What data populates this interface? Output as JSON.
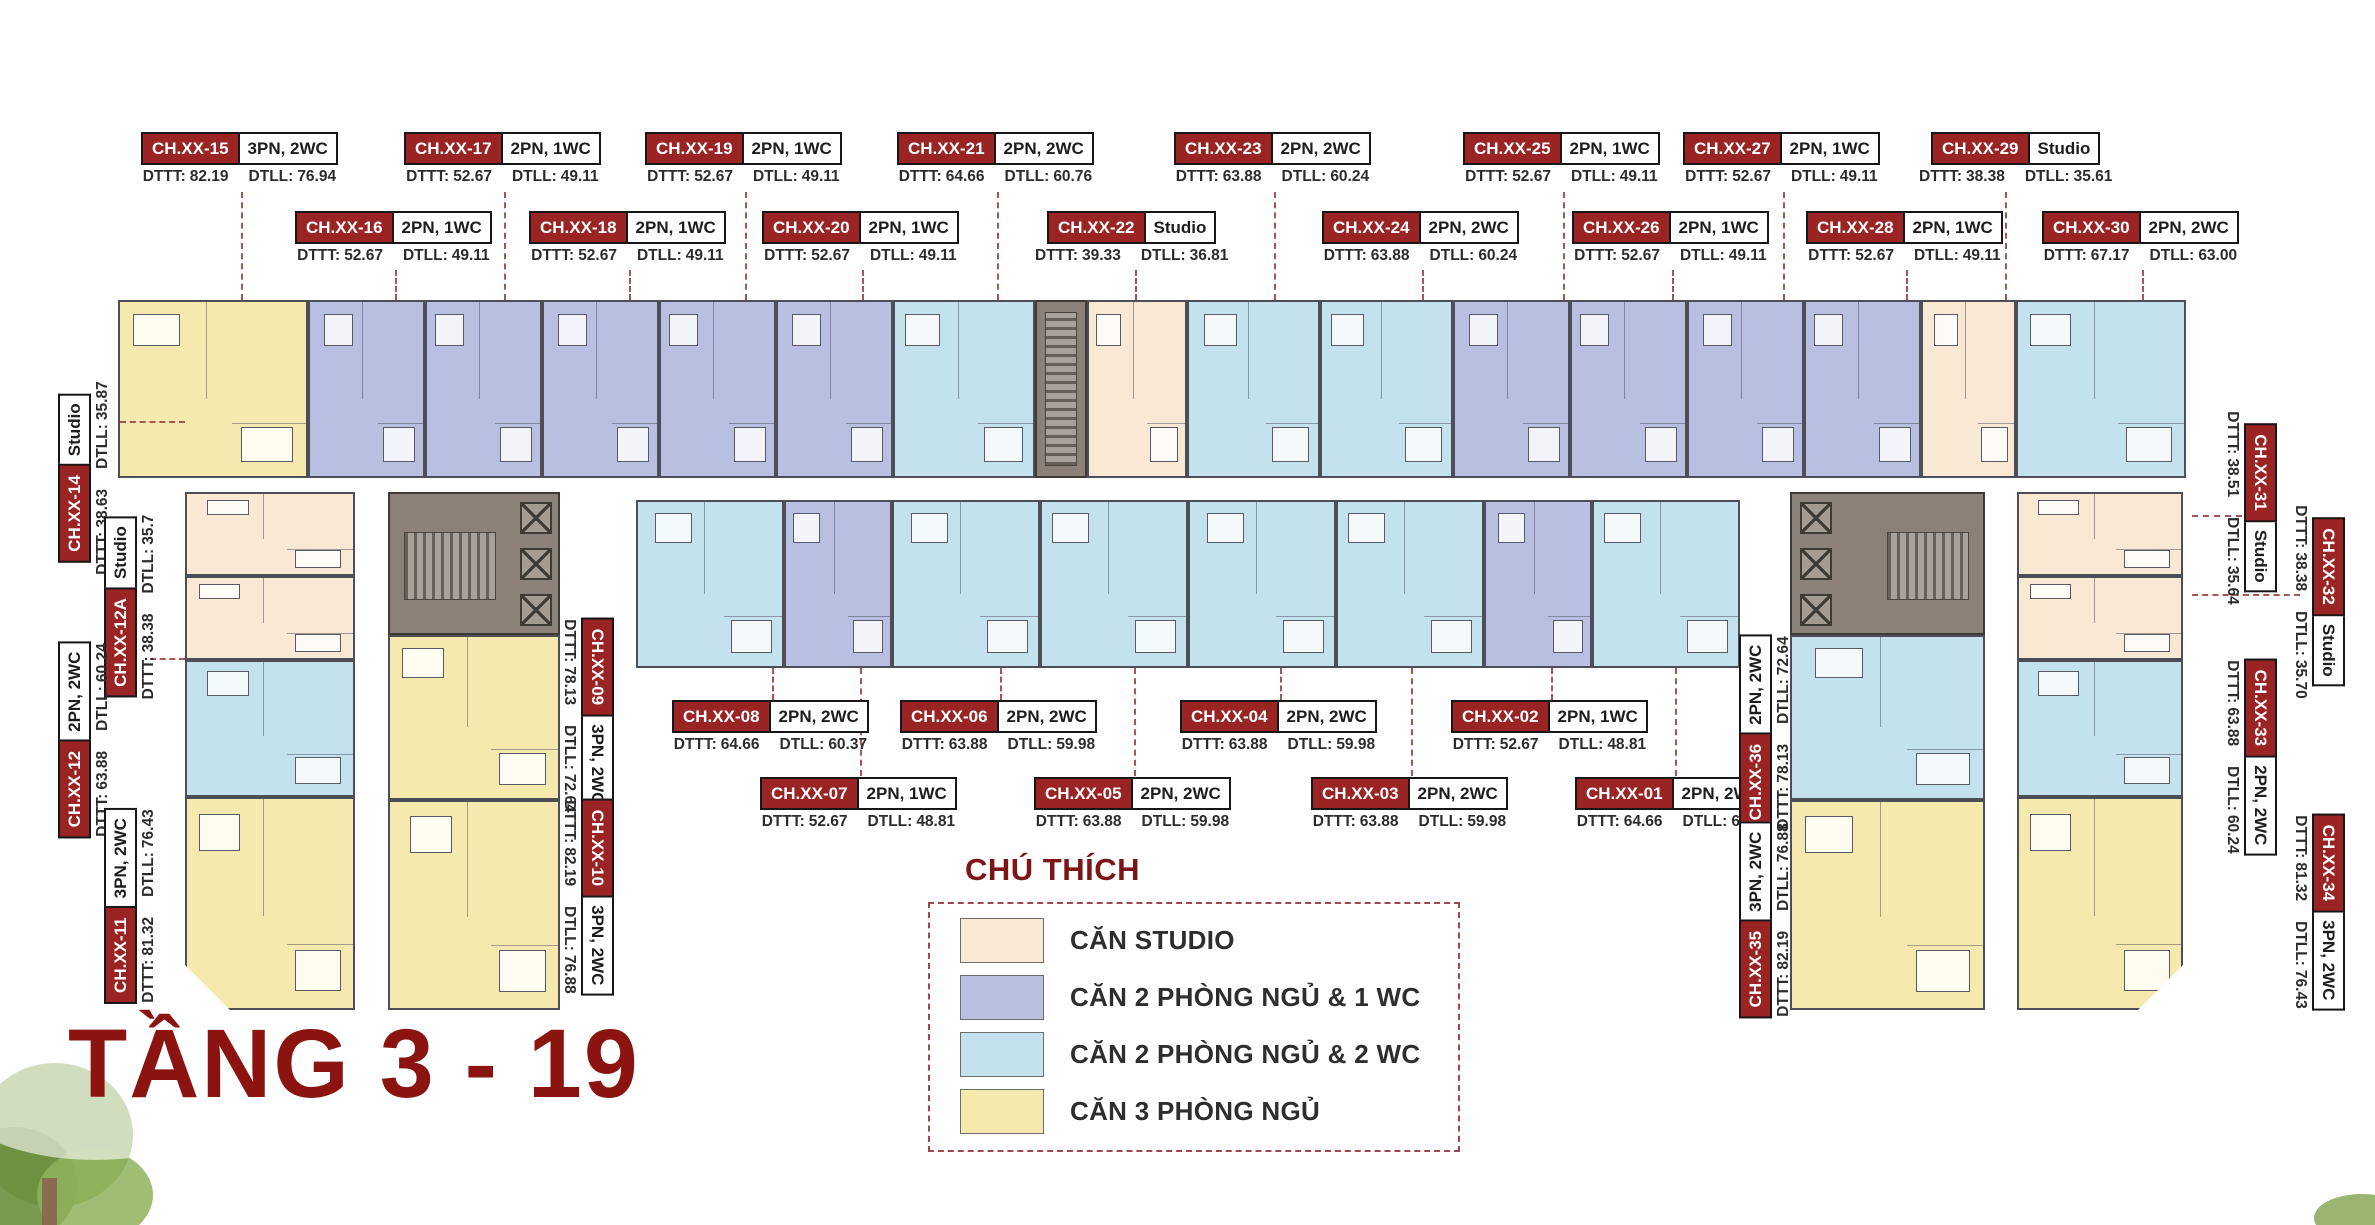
{
  "page": {
    "title": "TẦNG 3 - 19"
  },
  "legend": {
    "title": "CHÚ THÍCH",
    "items": [
      {
        "key": "studio",
        "label": "CĂN STUDIO",
        "color": "#f9e9d4"
      },
      {
        "key": "2pn1wc",
        "label": "CĂN 2 PHÒNG NGỦ & 1 WC",
        "color": "#b9bfe0"
      },
      {
        "key": "2pn2wc",
        "label": "CĂN 2 PHÒNG NGỦ & 2 WC",
        "color": "#c4e1ee"
      },
      {
        "key": "3pn",
        "label": "CĂN 3 PHÒNG NGỦ",
        "color": "#f6e9ae"
      }
    ]
  },
  "labels": {
    "dttt_prefix": "DTTT:",
    "dtll_prefix": "DTLL:"
  },
  "units": [
    {
      "id": "CH.XX-01",
      "type": "2PN, 2WC",
      "dttt": "64.66",
      "dtll": "60.37"
    },
    {
      "id": "CH.XX-02",
      "type": "2PN, 1WC",
      "dttt": "52.67",
      "dtll": "48.81"
    },
    {
      "id": "CH.XX-03",
      "type": "2PN, 2WC",
      "dttt": "63.88",
      "dtll": "59.98"
    },
    {
      "id": "CH.XX-04",
      "type": "2PN, 2WC",
      "dttt": "63.88",
      "dtll": "59.98"
    },
    {
      "id": "CH.XX-05",
      "type": "2PN, 2WC",
      "dttt": "63.88",
      "dtll": "59.98"
    },
    {
      "id": "CH.XX-06",
      "type": "2PN, 2WC",
      "dttt": "63.88",
      "dtll": "59.98"
    },
    {
      "id": "CH.XX-07",
      "type": "2PN, 1WC",
      "dttt": "52.67",
      "dtll": "48.81"
    },
    {
      "id": "CH.XX-08",
      "type": "2PN, 2WC",
      "dttt": "64.66",
      "dtll": "60.37"
    },
    {
      "id": "CH.XX-09",
      "type": "3PN, 2WC",
      "dttt": "78.13",
      "dtll": "72.64"
    },
    {
      "id": "CH.XX-10",
      "type": "3PN, 2WC",
      "dttt": "82.19",
      "dtll": "76.88"
    },
    {
      "id": "CH.XX-11",
      "type": "3PN, 2WC",
      "dttt": "81.32",
      "dtll": "76.43"
    },
    {
      "id": "CH.XX-12",
      "type": "2PN, 2WC",
      "dttt": "63.88",
      "dtll": "60.24"
    },
    {
      "id": "CH.XX-12A",
      "type": "Studio",
      "dttt": "38.38",
      "dtll": "35.7"
    },
    {
      "id": "CH.XX-14",
      "type": "Studio",
      "dttt": "38.63",
      "dtll": "35.87"
    },
    {
      "id": "CH.XX-15",
      "type": "3PN, 2WC",
      "dttt": "82.19",
      "dtll": "76.94"
    },
    {
      "id": "CH.XX-16",
      "type": "2PN, 1WC",
      "dttt": "52.67",
      "dtll": "49.11"
    },
    {
      "id": "CH.XX-17",
      "type": "2PN, 1WC",
      "dttt": "52.67",
      "dtll": "49.11"
    },
    {
      "id": "CH.XX-18",
      "type": "2PN, 1WC",
      "dttt": "52.67",
      "dtll": "49.11"
    },
    {
      "id": "CH.XX-19",
      "type": "2PN, 1WC",
      "dttt": "52.67",
      "dtll": "49.11"
    },
    {
      "id": "CH.XX-20",
      "type": "2PN, 1WC",
      "dttt": "52.67",
      "dtll": "49.11"
    },
    {
      "id": "CH.XX-21",
      "type": "2PN, 2WC",
      "dttt": "64.66",
      "dtll": "60.76"
    },
    {
      "id": "CH.XX-22",
      "type": "Studio",
      "dttt": "39.33",
      "dtll": "36.81"
    },
    {
      "id": "CH.XX-23",
      "type": "2PN, 2WC",
      "dttt": "63.88",
      "dtll": "60.24"
    },
    {
      "id": "CH.XX-24",
      "type": "2PN, 2WC",
      "dttt": "63.88",
      "dtll": "60.24"
    },
    {
      "id": "CH.XX-25",
      "type": "2PN, 1WC",
      "dttt": "52.67",
      "dtll": "49.11"
    },
    {
      "id": "CH.XX-26",
      "type": "2PN, 1WC",
      "dttt": "52.67",
      "dtll": "49.11"
    },
    {
      "id": "CH.XX-27",
      "type": "2PN, 1WC",
      "dttt": "52.67",
      "dtll": "49.11"
    },
    {
      "id": "CH.XX-28",
      "type": "2PN, 1WC",
      "dttt": "52.67",
      "dtll": "49.11"
    },
    {
      "id": "CH.XX-29",
      "type": "Studio",
      "dttt": "38.38",
      "dtll": "35.61"
    },
    {
      "id": "CH.XX-30",
      "type": "2PN, 2WC",
      "dttt": "67.17",
      "dtll": "63.00"
    },
    {
      "id": "CH.XX-31",
      "type": "Studio",
      "dttt": "38.51",
      "dtll": "35.64"
    },
    {
      "id": "CH.XX-32",
      "type": "Studio",
      "dttt": "38.38",
      "dtll": "35.70"
    },
    {
      "id": "CH.XX-33",
      "type": "2PN, 2WC",
      "dttt": "63.88",
      "dtll": "60.24"
    },
    {
      "id": "CH.XX-34",
      "type": "3PN, 2WC",
      "dttt": "81.32",
      "dtll": "76.43"
    },
    {
      "id": "CH.XX-35",
      "type": "3PN, 2WC",
      "dttt": "82.19",
      "dtll": "76.88"
    },
    {
      "id": "CH.XX-36",
      "type": "2PN, 2WC",
      "dttt": "78.13",
      "dtll": "72.64"
    }
  ]
}
